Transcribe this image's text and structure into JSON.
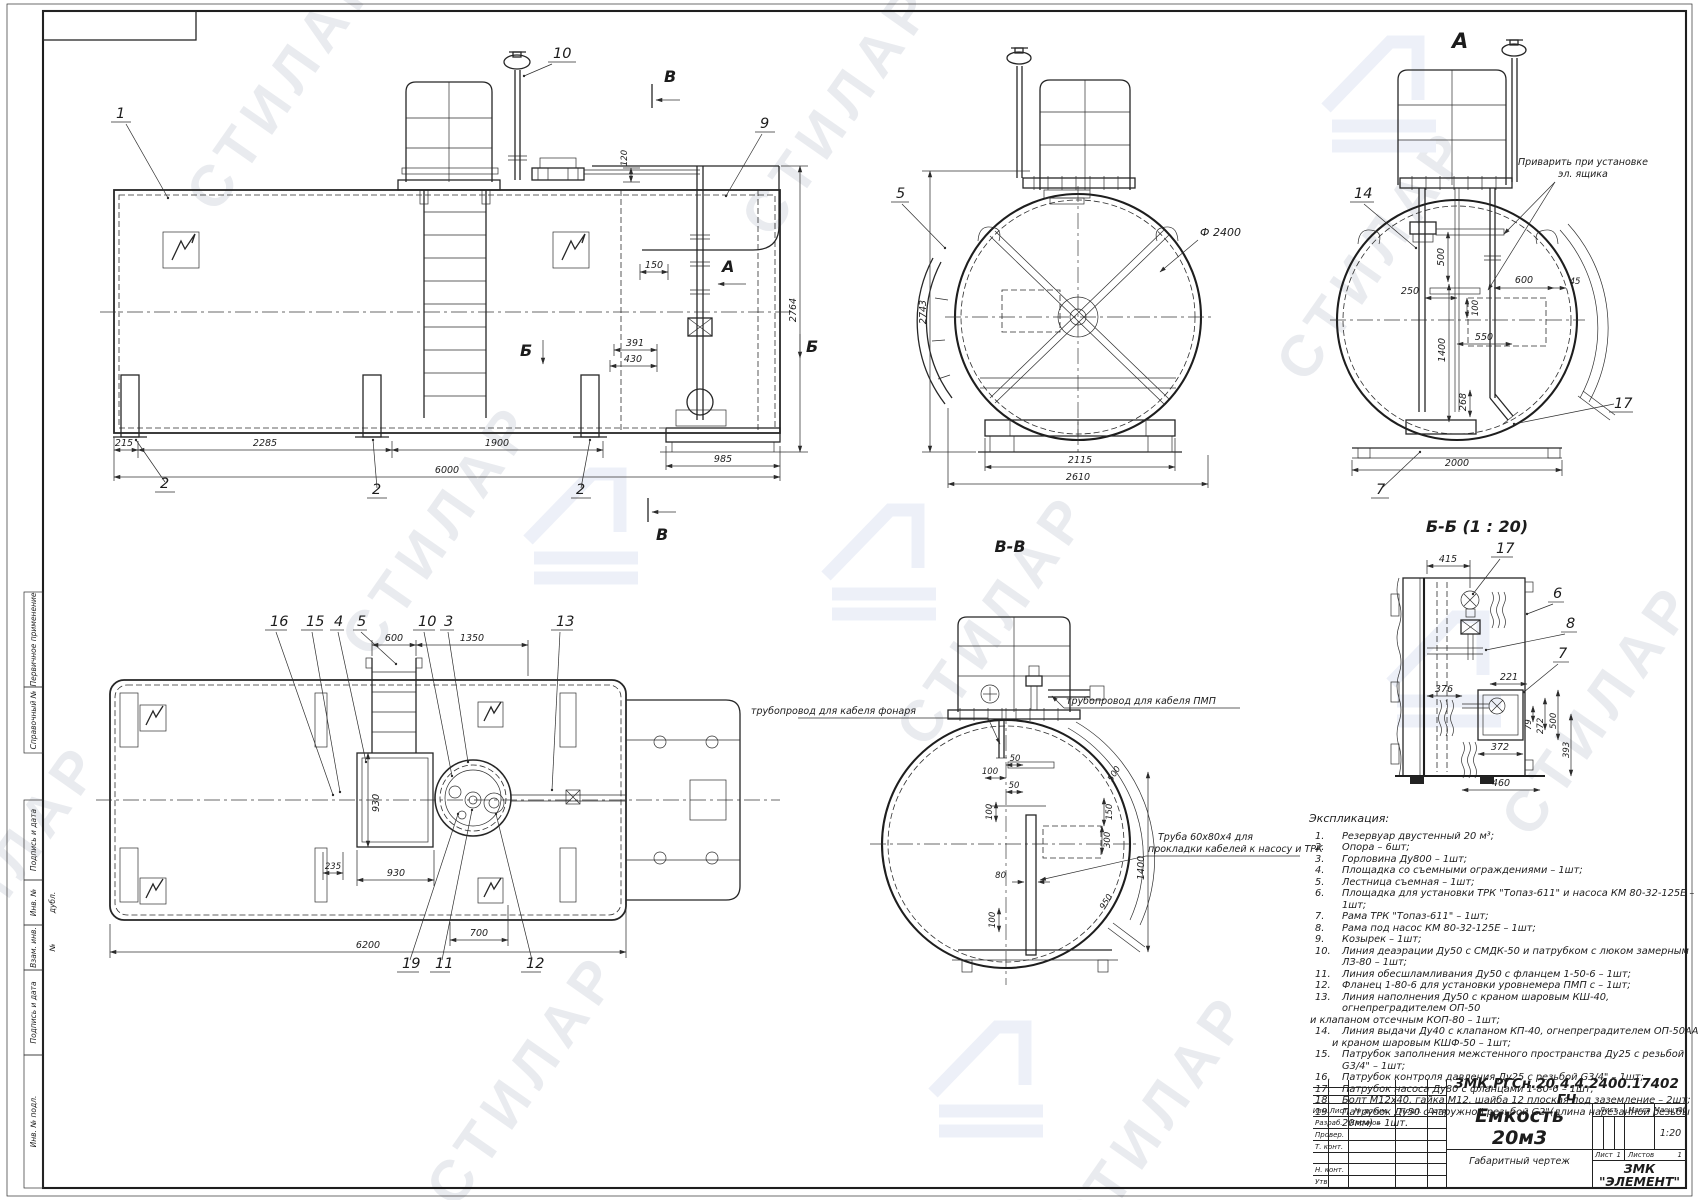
{
  "sheet": {
    "watermark_text": "СТИЛАР"
  },
  "margin_labels": {
    "primary_use": "Первичное применение",
    "ref_no": "Справочный №",
    "sign_date1": "Подпись и дата",
    "inv_dupl": "Инв. № дубл.",
    "vzam_inv": "Взам. инв. №",
    "sign_date2": "Подпись и дата",
    "inv_podl": "Инв. № подл."
  },
  "views": {
    "side": {
      "callout_1": "1",
      "callout_2": "2",
      "callout_9": "9",
      "callout_10": "10",
      "dim_215": "215",
      "dim_2285": "2285",
      "dim_1900": "1900",
      "dim_6000": "6000",
      "dim_985": "985",
      "dim_2764": "2764",
      "dim_120": "120",
      "dim_150": "150",
      "dim_391": "391",
      "dim_430": "430",
      "mark_a": "А",
      "mark_b": "Б",
      "mark_v": "В"
    },
    "front": {
      "callout_5": "5",
      "dia_2400": "Ф 2400",
      "dim_2743": "2743",
      "dim_2115": "2115",
      "dim_2610": "2610"
    },
    "view_a": {
      "title": "А",
      "callout_14": "14",
      "callout_17": "17",
      "callout_7": "7",
      "note_line1": "Приварить при установке",
      "note_line2": "эл. ящика",
      "dim_500": "500",
      "dim_250": "250",
      "dim_100": "100",
      "dim_1400": "1400",
      "dim_550": "550",
      "dim_268": "268",
      "dim_600": "600",
      "dim_45": "45",
      "dim_2000": "2000"
    },
    "section_vv": {
      "title": "В-В",
      "note_left": "трубопровод для кабеля фонаря",
      "note_right": "трубопровод для кабеля ПМП",
      "pipe_note_line1": "Труба 60х80х4 для",
      "pipe_note_line2": "прокладки кабелей к насосу и ТРК",
      "dim_100_top": "100",
      "dim_50_top": "50",
      "dim_50_mid": "50",
      "dim_100_mid": "100",
      "dim_150": "150",
      "dim_300": "300",
      "dim_80": "80",
      "dim_100_bot": "100",
      "dim_500": "500",
      "dim_1400": "1400",
      "dim_950": "950"
    },
    "section_bb": {
      "title": "Б-Б  (1 : 20)",
      "callout_17": "17",
      "callout_6": "6",
      "callout_8": "8",
      "callout_7": "7",
      "dim_415": "415",
      "dim_221": "221",
      "dim_376": "376",
      "dim_79": "79",
      "dim_272": "272",
      "dim_500": "500",
      "dim_372": "372",
      "dim_393": "393",
      "dim_460": "460"
    },
    "plan": {
      "callout_16": "16",
      "callout_15": "15",
      "callout_4": "4",
      "callout_5": "5",
      "callout_10": "10",
      "callout_3": "3",
      "callout_13": "13",
      "callout_19": "19",
      "callout_11": "11",
      "callout_12": "12",
      "dim_600": "600",
      "dim_1350": "1350",
      "dim_930_v": "930",
      "dim_235": "235",
      "dim_930": "930",
      "dim_700": "700",
      "dim_6200": "6200"
    }
  },
  "explication": {
    "title": "Экспликация:",
    "lines": [
      {
        "n": "1.",
        "t": "Резервуар двустенный 20 м³;"
      },
      {
        "n": "2.",
        "t": "Опора – 6шт;"
      },
      {
        "n": "3.",
        "t": "Горловина Ду800 – 1шт;"
      },
      {
        "n": "4.",
        "t": "Площадка со съемными ограждениями – 1шт;"
      },
      {
        "n": "5.",
        "t": "Лестница съемная – 1шт;"
      },
      {
        "n": "6.",
        "t": "Площадка для установки ТРК \"Топаз-611\" и насоса КМ 80-32-125Е – 1шт;"
      },
      {
        "n": "7.",
        "t": "Рама ТРК \"Топаз-611\" – 1шт;"
      },
      {
        "n": "8.",
        "t": "Рама под насос КМ 80-32-125Е – 1шт;"
      },
      {
        "n": "9.",
        "t": "Козырек – 1шт;"
      },
      {
        "n": "10.",
        "t": "Линия деаэрации Ду50 с СМДК-50 и патрубком с люком замерным ЛЗ-80 – 1шт;"
      },
      {
        "n": "11.",
        "t": "Линия обесшламливания Ду50 с фланцем 1-50-6 – 1шт;"
      },
      {
        "n": "12.",
        "t": "Фланец 1-80-6 для установки уровнемера ПМП с  – 1шт;"
      },
      {
        "n": "13.",
        "t": "Линия наполнения Ду50 с краном шаровым КШ-40, огнепреградителем ОП-50"
      },
      {
        "n": "",
        "t": "и клапаном отсечным КОП-80  – 1шт;"
      },
      {
        "n": "14.",
        "t": "Линия выдачи Ду40 с клапаном КП-40, огнепреградителем ОП-50АА"
      },
      {
        "n": "",
        "t": "и краном шаровым КШФ-50 – 1шт;"
      },
      {
        "n": "15.",
        "t": "Патрубок заполнения межстенного пространства Ду25 с резьбой G3/4\" – 1шт;"
      },
      {
        "n": "16.",
        "t": "Патрубок контроля давления Ду25 с резьбой G3/4\" – 1шт;"
      },
      {
        "n": "17.",
        "t": "Патрубок насоса Ду80 с фланцами 1-80-6 – 1шт;"
      },
      {
        "n": "18.",
        "t": "Болт М12х40, гайка М12, шайба 12 плоская под заземление – 2шт;"
      },
      {
        "n": "19.",
        "t": "Патрубок Ду50 с наружной резьбой G2\"(длина нарезанной резьбы 20мм) – 1шт."
      }
    ]
  },
  "title_block": {
    "doc_number": "ЗМК.РГСн.20.4.4.2400.17402 ГЧ",
    "product_title": "Емкость 20м3",
    "doc_type": "Габаритный чертеж",
    "company_line1": "ЗМК",
    "company_line2": "\"ЭЛЕМЕНТ\"",
    "col_izm": "Изм.",
    "col_list": "Лист",
    "col_doc": "№ докум.",
    "col_podp": "Подп.",
    "col_data": "Дата",
    "row_razrab": "Разраб.",
    "row_prover": "Провер.",
    "row_tkont": "Т. конт.",
    "row_nkont": "Н. конт.",
    "row_utv": "Утв.",
    "razrab_name": "Клочков",
    "lit_label": "Лист",
    "massa_label": "Масса",
    "scale_label": "Масштаб",
    "scale_value": "1:20",
    "sheet_label": "Лист",
    "sheet_num": "1",
    "sheets_label": "Листов",
    "sheets_num": "1"
  }
}
